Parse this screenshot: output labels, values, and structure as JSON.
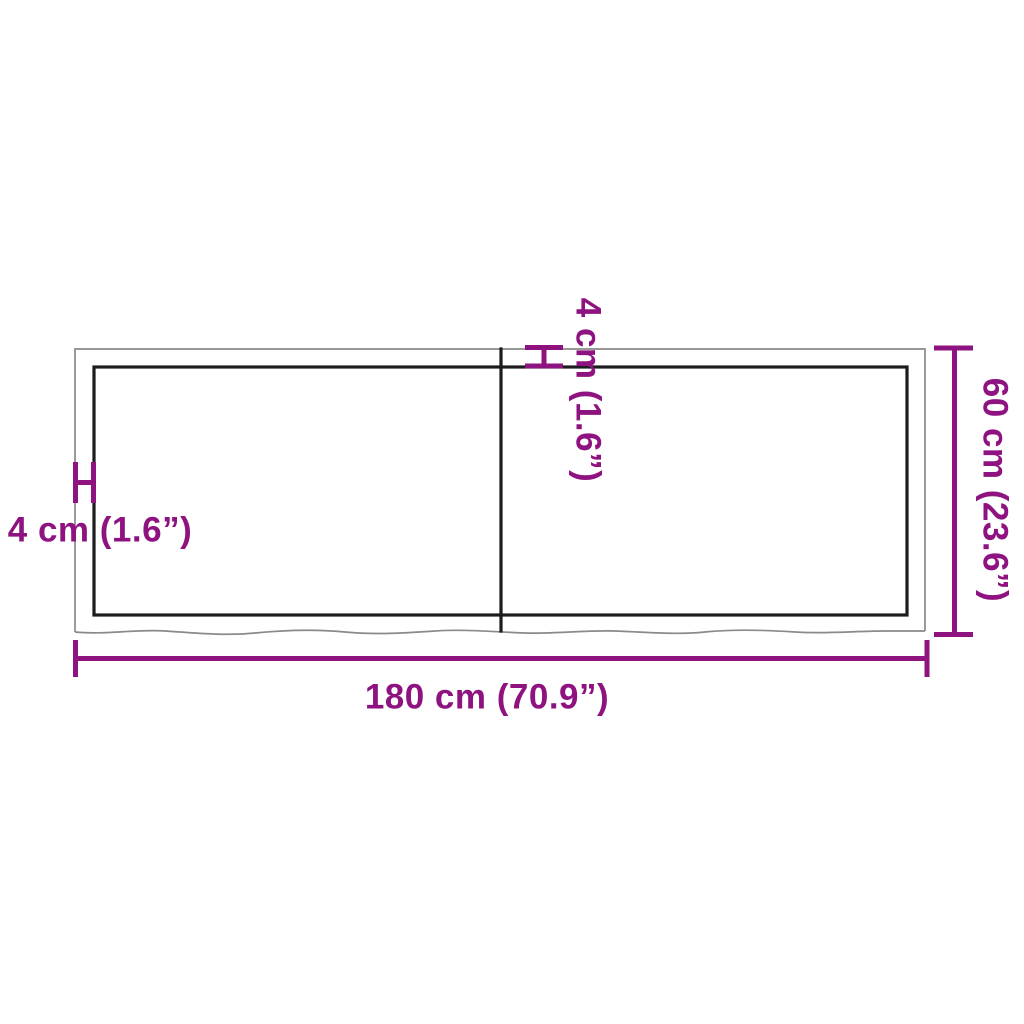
{
  "colors": {
    "accent": "#8E1380",
    "outline": "#8A8A8A",
    "edge": "#1C1C1C",
    "background": "#FFFFFF"
  },
  "dimensions": {
    "width_label": "180 cm (70.9”)",
    "height_label": "60 cm (23.6”)",
    "thickness_left_label": "4 cm (1.6”)",
    "thickness_top_label": "4 cm (1.6”)"
  }
}
